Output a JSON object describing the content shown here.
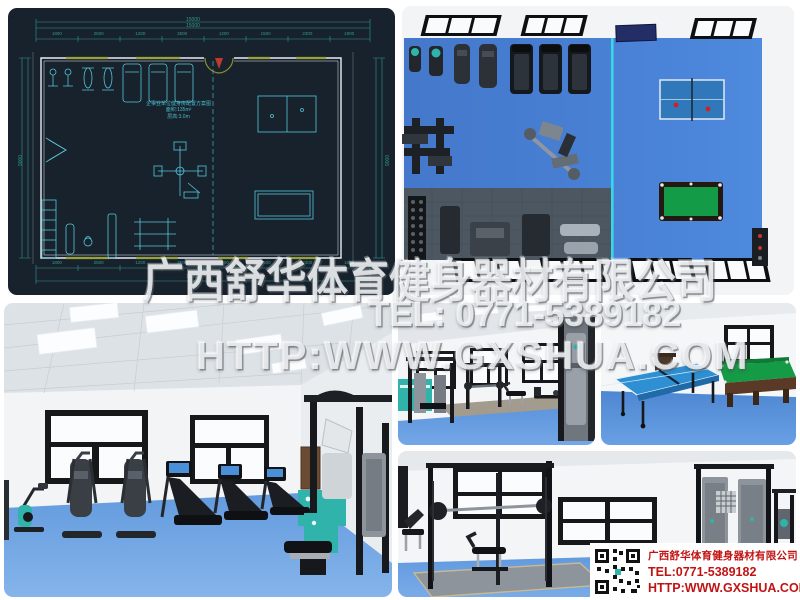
{
  "watermark": {
    "line1": "广西舒华体育健身器材有限公司",
    "line2": "TEL: 0771-5389182",
    "line3": "HTTP:WWW.GXSHUA.COM"
  },
  "info_box": {
    "company": "广西舒华体育健身器材有限公司",
    "tel": "TEL:0771-5389182",
    "website": "HTTP:WWW.GXSHUA.COM"
  },
  "cad_plan": {
    "dims": {
      "top_total_outer": "15000",
      "top_total_inner": "15000",
      "top_segments": [
        "1800",
        "2500",
        "1200",
        "3500",
        "1200",
        "1500",
        "2300",
        "1800"
      ],
      "bottom_segments": [
        "1800",
        "2500",
        "1200",
        "3500",
        "1200",
        "1500",
        "2300",
        "1800"
      ],
      "bottom_total": "15000",
      "left_total": "9000",
      "right_total": "9000"
    },
    "room_label": [
      "企事业单位健身房配置方案图",
      "面积:135m²",
      "层高:3.0m"
    ]
  },
  "colors": {
    "floor_blue": "#4E87D6",
    "floor_blue_light": "#6BA3E8",
    "table_tennis_blue": "#2E86C8",
    "pool_table_green": "#16A04A",
    "equipment_teal": "#2FB3AB",
    "cad_background": "#18222D",
    "cad_line_cyan": "#56C6D8",
    "cad_dim_green": "#2F9A8C",
    "watermark_white": "#F5F7F9",
    "info_text_red": "#C01414"
  }
}
